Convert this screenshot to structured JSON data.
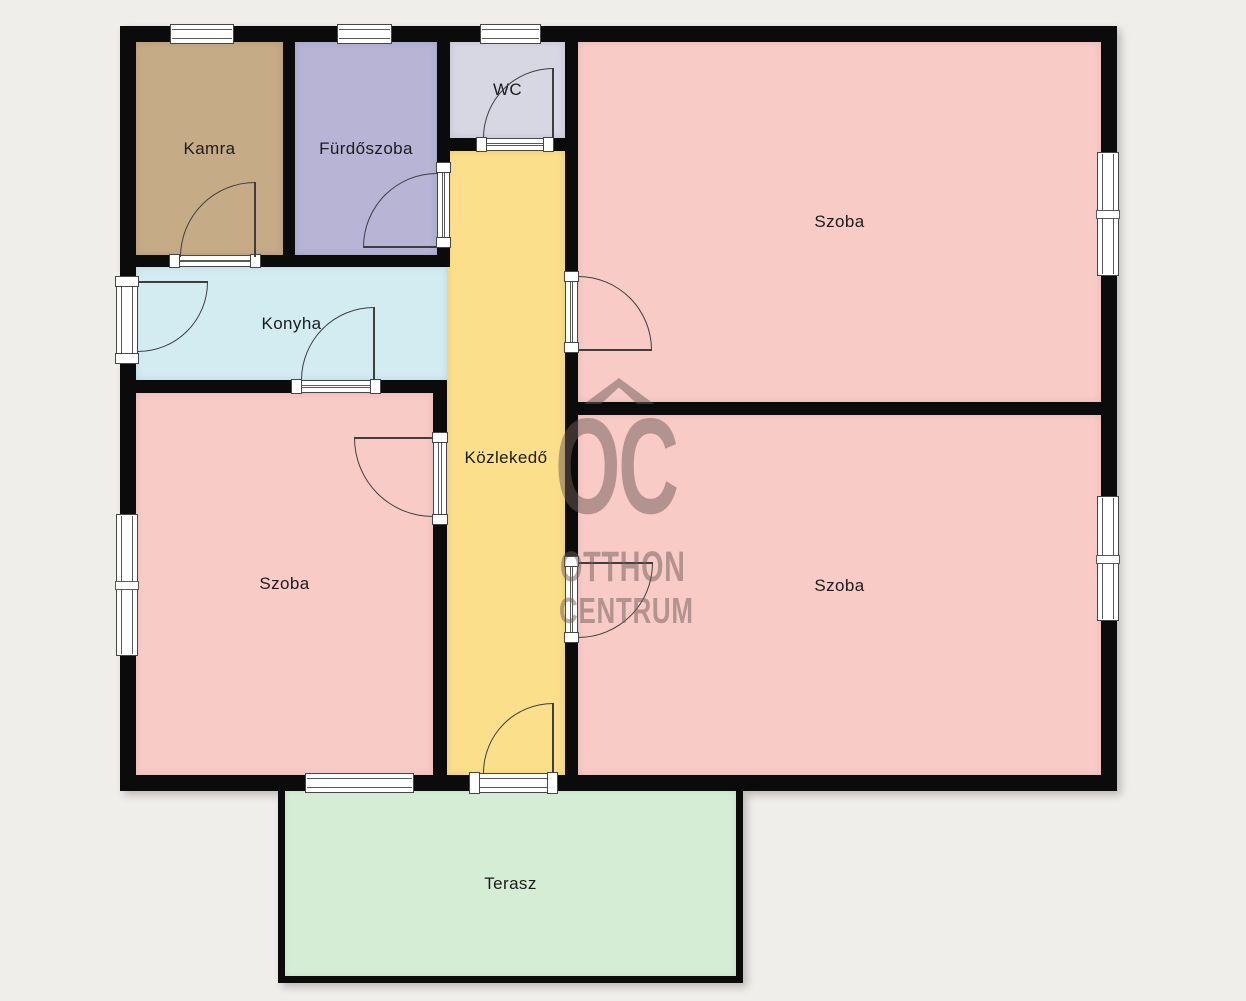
{
  "plan_title": "apartment-floor-plan",
  "rooms": {
    "kamra": {
      "label": "Kamra",
      "color": "#c6ab87"
    },
    "furdoszoba": {
      "label": "Fürdőszoba",
      "color": "#b7b4d6"
    },
    "wc": {
      "label": "WC",
      "color": "#d7d7e4"
    },
    "szoba_top_right": {
      "label": "Szoba",
      "color": "#f9cbc7"
    },
    "konyha": {
      "label": "Konyha",
      "color": "#d3ecf2"
    },
    "kozlekedo": {
      "label": "Közlekedő",
      "color": "#fbdf8a"
    },
    "szoba_bottom_left": {
      "label": "Szoba",
      "color": "#f9cbc7"
    },
    "szoba_bottom_right": {
      "label": "Szoba",
      "color": "#f9cbc7"
    },
    "terasz": {
      "label": "Terasz",
      "color": "#d5edd5"
    }
  },
  "watermark": {
    "symbol": "roof-chevron-icon",
    "line_top": "OC",
    "line_mid": "OTTHON",
    "line_bottom": "CENTRUM",
    "color": "rgba(110,92,87,0.5)"
  },
  "colors": {
    "background": "#f0eeea",
    "wall": "#0b0b0b"
  }
}
